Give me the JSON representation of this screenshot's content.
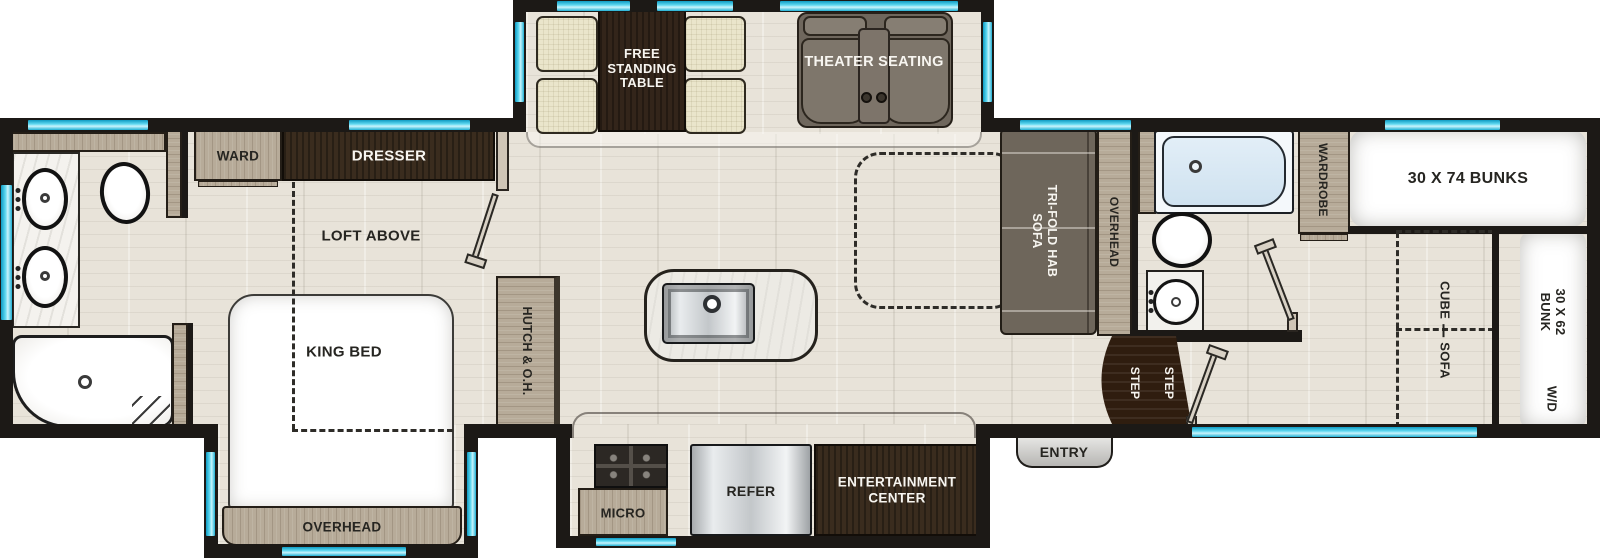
{
  "colors": {
    "wall": "#1c1916",
    "window_accent": "#35c3e2",
    "floor": "#e8e3d9",
    "wood_light": "#b7ab99",
    "wood_dark": "#3a2c1e",
    "sofa_gray": "#6f675d",
    "cushion_cream": "#eae5cb",
    "steps_brown": "#2f1d0f",
    "tub_blue": "#d7e7f3"
  },
  "slideout_dinette": {
    "table_label_lines": [
      "FREE",
      "STANDING",
      "TABLE"
    ],
    "theater_label": "THEATER SEATING"
  },
  "bedroom": {
    "ward": "WARD",
    "dresser": "DRESSER",
    "loft": "LOFT ABOVE",
    "bed": "KING BED",
    "overhead": "OVERHEAD"
  },
  "kitchen": {
    "hutch": "HUTCH & O.H.",
    "micro": "MICRO",
    "refer": "REFER",
    "entertainment": [
      "ENTERTAINMENT",
      "CENTER"
    ]
  },
  "living": {
    "sofa": [
      "TRI-FOLD HAB",
      "SOFA"
    ],
    "overhead": "OVERHEAD"
  },
  "bath_mid": {
    "wardrobe": "WARDROBE"
  },
  "entryway": {
    "label": "ENTRY",
    "step": "STEP"
  },
  "bunkroom": {
    "bunks": "30 X 74 BUNKS",
    "cube_sofa": [
      "CUBE",
      "SOFA"
    ],
    "bunk": [
      "30 X 62",
      "BUNK"
    ],
    "wd": "W/D"
  }
}
